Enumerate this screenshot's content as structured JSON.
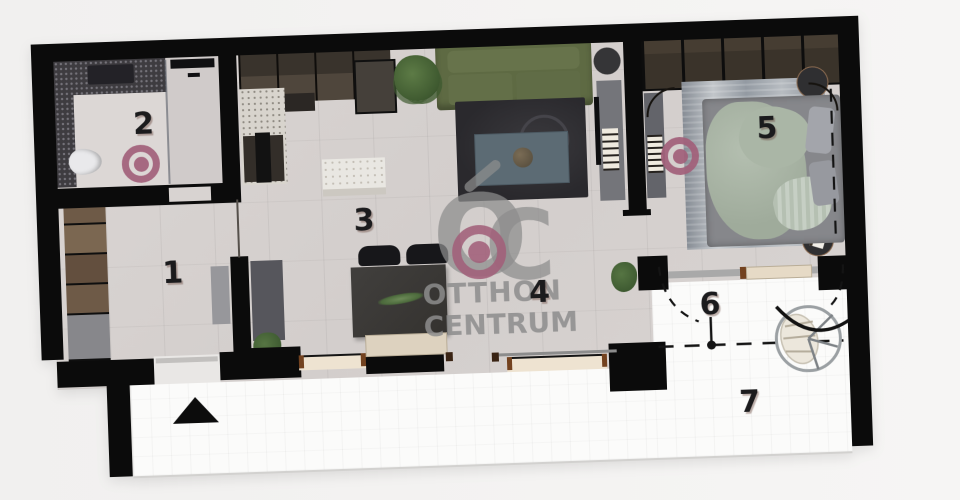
{
  "plan": {
    "room_labels": {
      "r1": "1",
      "r2": "2",
      "r3": "3",
      "r4": "4",
      "r5": "5",
      "r6": "6",
      "r7": "7"
    },
    "watermark": {
      "monogram_o": "O",
      "monogram_c": "C",
      "line1": "OTTHON",
      "line2": "CENTRUM"
    },
    "colors": {
      "accent": "#a2607a",
      "watermark_gray": "#8d8d8d",
      "wall": "#0b0b0b",
      "interior_floor": "#d7d2d0",
      "terrace_floor": "#fbfbfa",
      "sofa": "#5e6a43",
      "bed_blanket": "#a9b4a5",
      "living_rug": "#2d2c30",
      "coffee_table": "#5c6b74"
    }
  }
}
